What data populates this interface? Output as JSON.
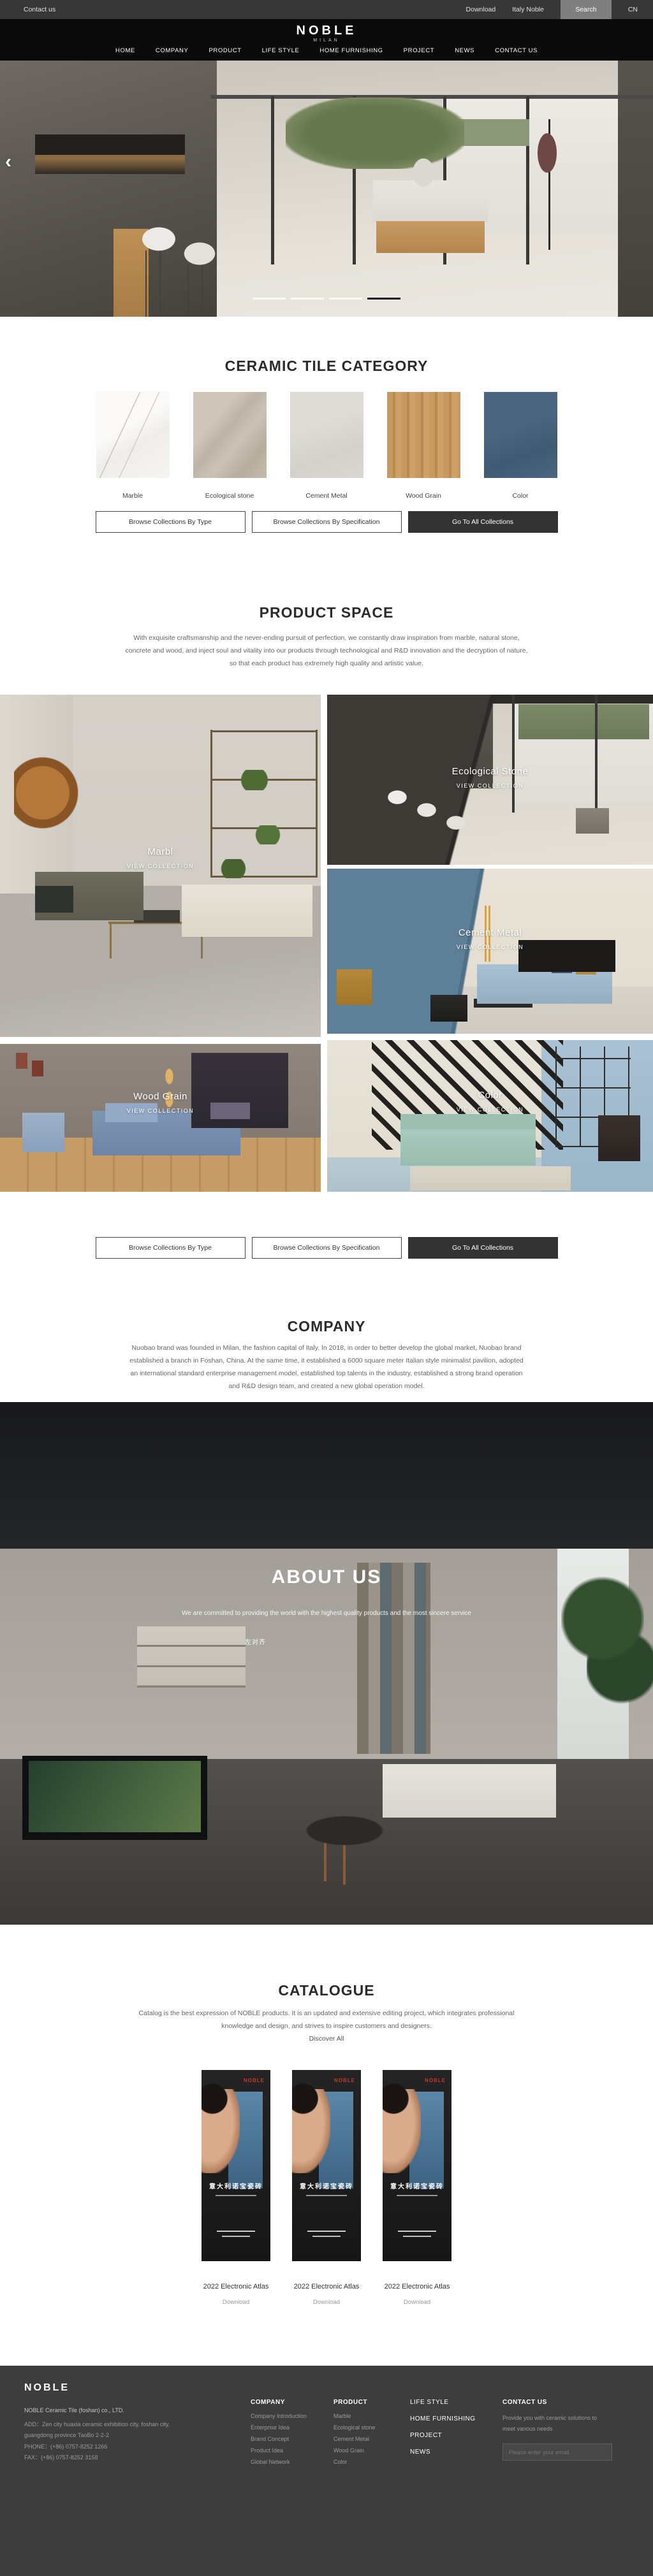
{
  "topbar": {
    "contact_us": "Contact us",
    "download": "Download",
    "italy_noble": "Italy Noble",
    "search": "Search",
    "lang": "CN"
  },
  "header": {
    "logo": "NOBLE",
    "logo_subtitle": "MILAN",
    "nav": [
      "HOME",
      "COMPANY",
      "PRODUCT",
      "LIFE STYLE",
      "HOME FURNISHING",
      "PROJECT",
      "NEWS",
      "CONTACT US"
    ]
  },
  "hero": {
    "prev_arrow": "‹",
    "slide_count": 4,
    "active_slide": 4
  },
  "category": {
    "title": "CERAMIC TILE CATEGORY",
    "swatches": [
      {
        "label": "Marble"
      },
      {
        "label": "Ecological stone"
      },
      {
        "label": "Cement Metal"
      },
      {
        "label": "Wood Grain"
      },
      {
        "label": "Color"
      }
    ]
  },
  "collection_buttons": {
    "by_type": "Browse Collections By Type",
    "by_spec": "Browse Collections By Specification",
    "go_all": "Go To All Collections"
  },
  "product_space": {
    "title": "PRODUCT SPACE",
    "paragraph": "With exquisite craftsmanship and the never-ending pursuit of perfection, we constantly draw inspiration from marble, natural stone, concrete and wood, and inject soul and vitality into our products through technological and R&D innovation and the decryption of nature, so that each product has extremely high quality and artistic value.",
    "tiles": [
      {
        "name": "Marbl",
        "cta": "VIEW COLLECTION"
      },
      {
        "name": "Ecological Stone",
        "cta": "VIEW COLLECTION"
      },
      {
        "name": "Cement Metal",
        "cta": "VIEW COLLECTION"
      },
      {
        "name": "Wood Grain",
        "cta": "VIEW COLLECTION"
      },
      {
        "name": "Color",
        "cta": "VIEW COLLECTION"
      }
    ]
  },
  "company": {
    "title": "COMPANY",
    "paragraph": "Nuobao brand was founded in Milan, the fashion capital of Italy. In 2018, in order to better develop the global market, Nuobao brand established a branch in Foshan, China. At the same time, it established a 6000 square meter Italian style minimalist pavilion, adopted an international standard enterprise management model, established top talents in the industry, established a strong brand operation and R&D design team, and created a new global operation model."
  },
  "about": {
    "title": "ABOUT US",
    "subtitle": "We are committed to providing the world with the highest quality products and the most sincere service",
    "note": "左对齐"
  },
  "catalogue": {
    "title": "CATALOGUE",
    "paragraph": "Catalog is the best expression of NOBLE products. It is an updated and extensive editing project, which integrates professional knowledge and design, and strives to inspire customers and designers.",
    "discover_all": "Discover All",
    "cover_brand": "NOBLE",
    "cover_title_cn": "意大利诺宝瓷砖",
    "items": [
      {
        "title": "2022 Electronic Atlas",
        "download": "Download"
      },
      {
        "title": "2022 Electronic Atlas",
        "download": "Download"
      },
      {
        "title": "2022 Electronic Atlas",
        "download": "Download"
      }
    ]
  },
  "footer": {
    "logo": "NOBLE",
    "company_name": "NOBLE Ceramic Tile (foshan) co., LTD.",
    "address": "ADD：Zen city huaxia ceramic exhibition city, foshan city, guangdong province TaoBo 2-2-2",
    "phone": "PHONE：(+86) 0757-8252 1266",
    "fax": "FAX：(+86) 0757-8252 3158",
    "columns": [
      {
        "title": "COMPANY",
        "items": [
          "Company Introduction",
          "Enterprise Idea",
          "Brand Concept",
          "Product Idea",
          "Global Network"
        ]
      },
      {
        "title": "PRODUCT",
        "items": [
          "Marble",
          "Ecological stone",
          "Cement Metal",
          "Wood Grain",
          "Color"
        ]
      }
    ],
    "links": [
      "LIFE STYLE",
      "HOME FURNISHING",
      "PROJECT",
      "NEWS"
    ],
    "contact": {
      "title": "CONTACT US",
      "text": "Provide you with ceramic solutions to meet various needs",
      "placeholder": "Please enter your email"
    }
  },
  "colors": {
    "topbar_bg": "#373737",
    "header_bg": "#0a0a0a",
    "footer_bg": "#3d3d3d",
    "dark_button": "#333333",
    "accent_red": "#c0392b",
    "cover_blue": "#4a6f8e",
    "swatch_marble": "#f3f1ee",
    "swatch_eco": "#c7bfb2",
    "swatch_cement": "#d9d6d1",
    "swatch_wood": "#c2945c",
    "swatch_color": "#44607a"
  }
}
